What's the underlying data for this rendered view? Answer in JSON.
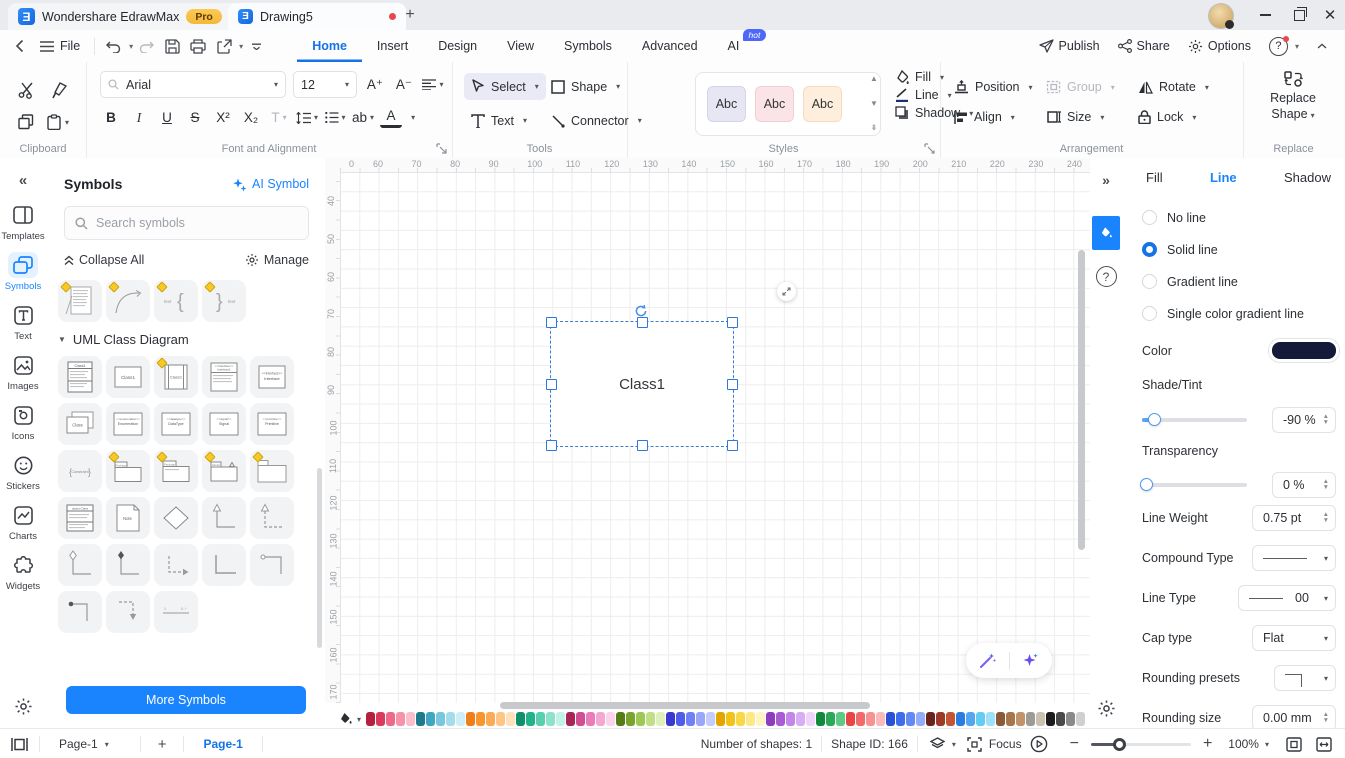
{
  "titlebar": {
    "app_tab": "Wondershare EdrawMax",
    "pro_badge": "Pro",
    "doc_tab": "Drawing5"
  },
  "menubar": {
    "file": "File",
    "tabs": [
      {
        "label": "Home",
        "active": true
      },
      {
        "label": "Insert"
      },
      {
        "label": "Design"
      },
      {
        "label": "View"
      },
      {
        "label": "Symbols"
      },
      {
        "label": "Advanced"
      },
      {
        "label": "AI",
        "badge": "hot"
      }
    ],
    "publish": "Publish",
    "share": "Share",
    "options": "Options"
  },
  "ribbon": {
    "clipboard_label": "Clipboard",
    "font": {
      "family": "Arial",
      "size": "12"
    },
    "font_buttons": {
      "bold": "B",
      "italic": "I",
      "underline": "U",
      "strike": "S",
      "sup": "X²",
      "sub": "X₂",
      "case": "T",
      "ab": "ab",
      "color": "A"
    },
    "font_label": "Font and Alignment",
    "tools": {
      "select": "Select",
      "shape": "Shape",
      "text": "Text",
      "connector": "Connector",
      "label": "Tools"
    },
    "styles": {
      "samples": [
        {
          "label": "Abc",
          "bg": "#e7e7f4",
          "border": "#d4d4ea"
        },
        {
          "label": "Abc",
          "bg": "#fbe4e8",
          "border": "#f4cdd4"
        },
        {
          "label": "Abc",
          "bg": "#fdeede",
          "border": "#f7dcbd"
        }
      ],
      "fill": "Fill",
      "line": "Line",
      "shadow": "Shadow",
      "label": "Styles"
    },
    "arrangement": {
      "position": "Position",
      "group": "Group",
      "rotate": "Rotate",
      "align": "Align",
      "size": "Size",
      "lock": "Lock",
      "label": "Arrangement"
    },
    "replace": {
      "button": "Replace Shape",
      "label": "Replace"
    }
  },
  "sidebar": {
    "items": [
      {
        "label": "Templates",
        "icon": "templates-icon"
      },
      {
        "label": "Symbols",
        "icon": "symbols-icon",
        "active": true
      },
      {
        "label": "Text",
        "icon": "text-icon"
      },
      {
        "label": "Images",
        "icon": "images-icon"
      },
      {
        "label": "Icons",
        "icon": "icons-icon"
      },
      {
        "label": "Stickers",
        "icon": "stickers-icon"
      },
      {
        "label": "Charts",
        "icon": "charts-icon"
      },
      {
        "label": "Widgets",
        "icon": "widgets-icon"
      }
    ]
  },
  "symbols_panel": {
    "title": "Symbols",
    "ai_symbol": "AI Symbol",
    "search_placeholder": "Search symbols",
    "collapse_all": "Collapse All",
    "manage": "Manage",
    "section": "UML Class Diagram",
    "more_button": "More Symbols",
    "partial_row": [
      {
        "type": "note-lines",
        "marker": true,
        "name": "text-block"
      },
      {
        "type": "arc",
        "marker": true,
        "name": "arc-connector"
      },
      {
        "type": "brace-left",
        "marker": true,
        "label": "text",
        "name": "left-brace"
      },
      {
        "type": "brace-right",
        "marker": true,
        "label": "text",
        "name": "right-brace"
      }
    ],
    "grid": [
      [
        {
          "type": "class-detailed",
          "label": "Class1",
          "name": "class-with-members"
        },
        {
          "type": "class-simple",
          "label": "Class1",
          "name": "class"
        },
        {
          "type": "class-sidebars",
          "label": "Class1",
          "marker": true,
          "name": "active-class"
        },
        {
          "type": "interface-ops",
          "label": "Interface1",
          "name": "interface-with-operations"
        },
        {
          "type": "interface",
          "label": "Interface",
          "name": "interface"
        }
      ],
      [
        {
          "type": "class-stack",
          "label": "Class",
          "name": "multiple-class"
        },
        {
          "type": "stereotype",
          "label": "Enumeration",
          "name": "enumeration"
        },
        {
          "type": "stereotype",
          "label": "DataType",
          "name": "datatype"
        },
        {
          "type": "stereotype",
          "label": "Signal",
          "name": "signal"
        },
        {
          "type": "stereotype",
          "label": "Primitive",
          "name": "primitive"
        }
      ],
      [
        {
          "type": "constraint",
          "label": "Constraint",
          "name": "constraint"
        },
        {
          "type": "package",
          "marker": true,
          "name": "package"
        },
        {
          "type": "package-labeled",
          "marker": true,
          "name": "package-labeled"
        },
        {
          "type": "model",
          "marker": true,
          "name": "model"
        },
        {
          "type": "folder-plain",
          "marker": true,
          "name": "subsystem"
        }
      ],
      [
        {
          "type": "object-table",
          "name": "object"
        },
        {
          "type": "note",
          "label": "Note",
          "name": "note"
        },
        {
          "type": "diamond",
          "name": "decision"
        },
        {
          "type": "corner-arrow",
          "name": "generalization-connector"
        },
        {
          "type": "corner-dashed",
          "name": "dependency-connector"
        }
      ],
      [
        {
          "type": "corner-diamond",
          "name": "aggregation-connector"
        },
        {
          "type": "corner-dot",
          "name": "composition-connector"
        },
        {
          "type": "dashed-right-arrow",
          "name": "realization-connector"
        },
        {
          "type": "corner-plain",
          "name": "association-connector"
        },
        {
          "type": "corner-arrow-left",
          "name": "directed-association"
        }
      ],
      [
        {
          "type": "corner-dot-left",
          "name": "composition-left"
        },
        {
          "type": "dashed-down-arrow",
          "name": "dependency-down"
        },
        {
          "type": "measure",
          "name": "multiplicity-link"
        }
      ]
    ]
  },
  "canvas": {
    "h_ruler": [
      "0",
      "60",
      "70",
      "80",
      "90",
      "100",
      "110",
      "120",
      "130",
      "140",
      "150",
      "160",
      "170",
      "180",
      "190",
      "200",
      "210",
      "220",
      "230",
      "240"
    ],
    "v_ruler": [
      "40",
      "50",
      "60",
      "70",
      "80",
      "90",
      "100",
      "110",
      "120",
      "130",
      "140",
      "150",
      "160",
      "170"
    ],
    "shape_label": "Class1"
  },
  "right_panel": {
    "tabs": [
      {
        "label": "Fill"
      },
      {
        "label": "Line",
        "active": true
      },
      {
        "label": "Shadow"
      }
    ],
    "line_options": [
      {
        "label": "No line"
      },
      {
        "label": "Solid line",
        "selected": true
      },
      {
        "label": "Gradient line"
      },
      {
        "label": "Single color gradient line"
      }
    ],
    "color_label": "Color",
    "color_value": "#151a3a",
    "shade_label": "Shade/Tint",
    "shade_value": "-90 %",
    "transparency_label": "Transparency",
    "transparency_value": "0 %",
    "line_weight_label": "Line Weight",
    "line_weight_value": "0.75 pt",
    "compound_label": "Compound Type",
    "line_type_label": "Line Type",
    "line_type_value": "00",
    "cap_label": "Cap type",
    "cap_value": "Flat",
    "rounding_presets_label": "Rounding presets",
    "rounding_size_label": "Rounding size",
    "rounding_size_value": "0.00 mm"
  },
  "statusbar": {
    "page_dropdown": "Page-1",
    "page_tab": "Page-1",
    "shapes_count": "Number of shapes: 1",
    "shape_id": "Shape ID: 166",
    "focus": "Focus",
    "zoom": "100%"
  },
  "color_strip": [
    "#b5203f",
    "#d93b5c",
    "#ef6a88",
    "#f693ab",
    "#fbbecd",
    "#1f7a8c",
    "#3fa7c4",
    "#79c7dd",
    "#a5dcec",
    "#cdeef7",
    "#ef7d1a",
    "#f9952e",
    "#fbab55",
    "#fdc688",
    "#fee0ba",
    "#0f8f6a",
    "#22b388",
    "#58cfae",
    "#8ce2ca",
    "#c2f2e3",
    "#a82558",
    "#d14f93",
    "#ea7cb8",
    "#f5a7d3",
    "#fbd3ea",
    "#567d15",
    "#79a52c",
    "#9dc854",
    "#c0df87",
    "#def0ba",
    "#3939cf",
    "#4f5ee9",
    "#7280f6",
    "#9aa6fa",
    "#c4cbfd",
    "#e3a500",
    "#f2c318",
    "#f9d848",
    "#fce985",
    "#fef4c2",
    "#8f3bbf",
    "#a95cd5",
    "#c287e8",
    "#d9adf4",
    "#edd4fa",
    "#128a3e",
    "#2aaa58",
    "#5cc985",
    "#e84545",
    "#f16b6b",
    "#f79292",
    "#fbbaba",
    "#2b50d8",
    "#3f6ceb",
    "#6489f4",
    "#93acf9",
    "#6b241c",
    "#9c3a26",
    "#c35434",
    "#2a7de0",
    "#53a6ef",
    "#63cdf3",
    "#9ce0f9",
    "#8a5a38",
    "#a8764e",
    "#c29268",
    "#9c9c94",
    "#c9c2b1",
    "#1b1b1b",
    "#4a4a4a",
    "#8a8a8a",
    "#d0d0d0"
  ]
}
